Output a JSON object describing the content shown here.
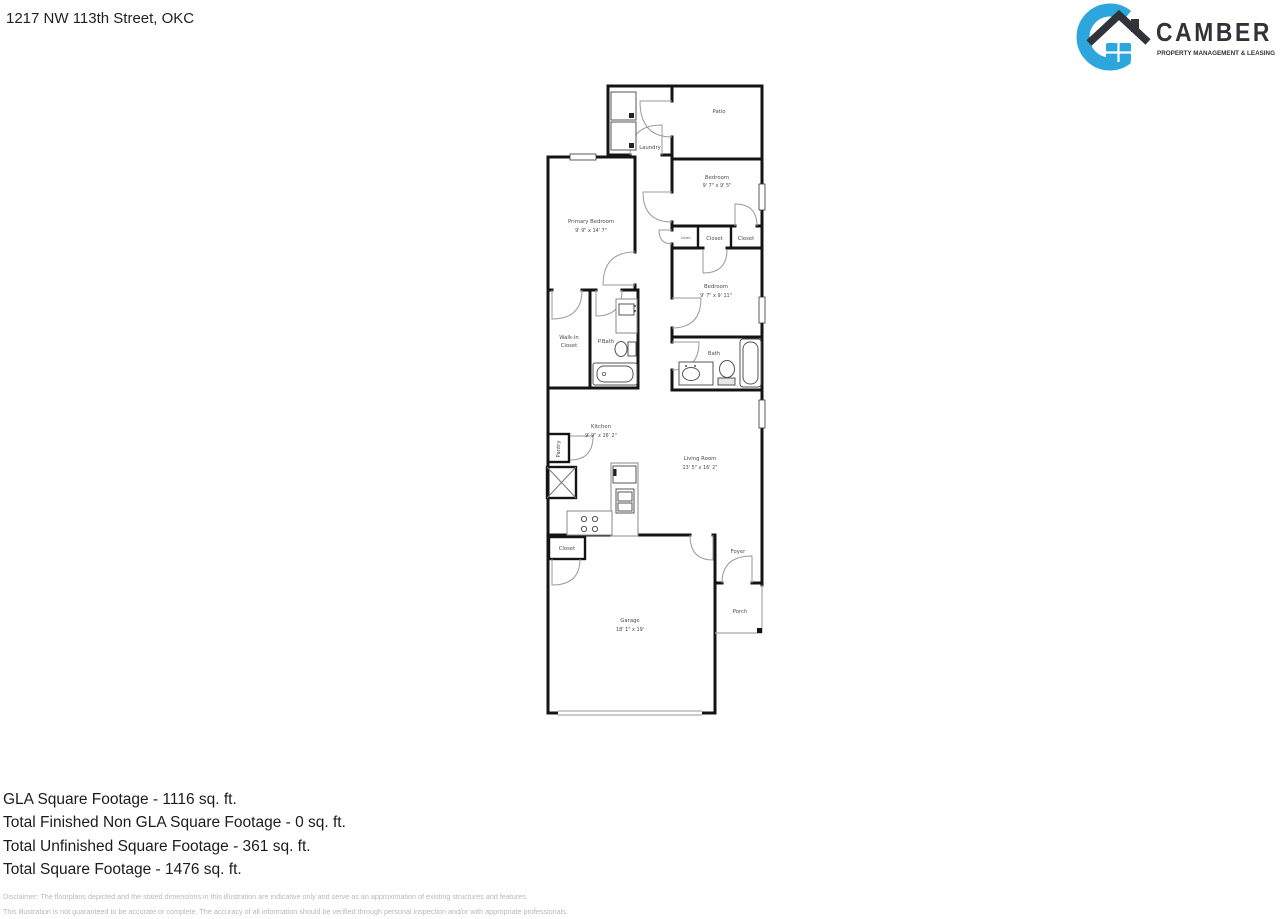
{
  "header": {
    "address": "1217 NW 113th Street, OKC"
  },
  "logo": {
    "brand": "CAMBER",
    "tagline": "PROPERTY MANAGEMENT & LEASING",
    "accent_color": "#2CA6DC",
    "dark_color": "#30343A"
  },
  "plan": {
    "rooms": {
      "laundry": {
        "label": "Laundry"
      },
      "patio": {
        "label": "Patio"
      },
      "bedroom1": {
        "label": "Bedroom",
        "dims": "9' 7\" x 9' 5\""
      },
      "linen": {
        "label": "Linen"
      },
      "closet1": {
        "label": "Closet"
      },
      "closet2": {
        "label": "Closet"
      },
      "bedroom2": {
        "label": "Bedroom",
        "dims": "9' 7\" x 9' 11\""
      },
      "bath": {
        "label": "Bath"
      },
      "primary_bedroom": {
        "label": "Primary Bedroom",
        "dims": "9' 9\" x 14' 7\""
      },
      "walk_in_closet": {
        "line1": "Walk-In",
        "line2": "Closet"
      },
      "p_bath": {
        "label": "P.Bath"
      },
      "kitchen": {
        "label": "Kitchen",
        "dims": "9' 9\" x 16' 2\""
      },
      "pantry": {
        "label": "Pantry"
      },
      "living_room": {
        "label": "Living Room",
        "dims": "13' 5\" x 16' 2\""
      },
      "entry_closet": {
        "label": "Closet"
      },
      "garage": {
        "label": "Garage",
        "dims": "18' 1\" x 19'"
      },
      "foyer": {
        "label": "Foyer"
      },
      "porch": {
        "label": "Porch"
      }
    }
  },
  "footer": {
    "lines": [
      "GLA Square Footage - 1116 sq. ft.",
      "Total Finished Non GLA Square Footage - 0 sq. ft.",
      "Total Unfinished Square Footage - 361 sq. ft.",
      "Total Square Footage - 1476 sq. ft."
    ],
    "disclaimer": [
      "Disclaimer: The floorplans depicted and the stated dimensions in this illustration are indicative only and serve as an approximation of existing structures and features.",
      "This illustration is not guaranteed to be accurate or complete. The accuracy of all information should be verified through personal inspection and/or with appropriate professionals."
    ]
  }
}
